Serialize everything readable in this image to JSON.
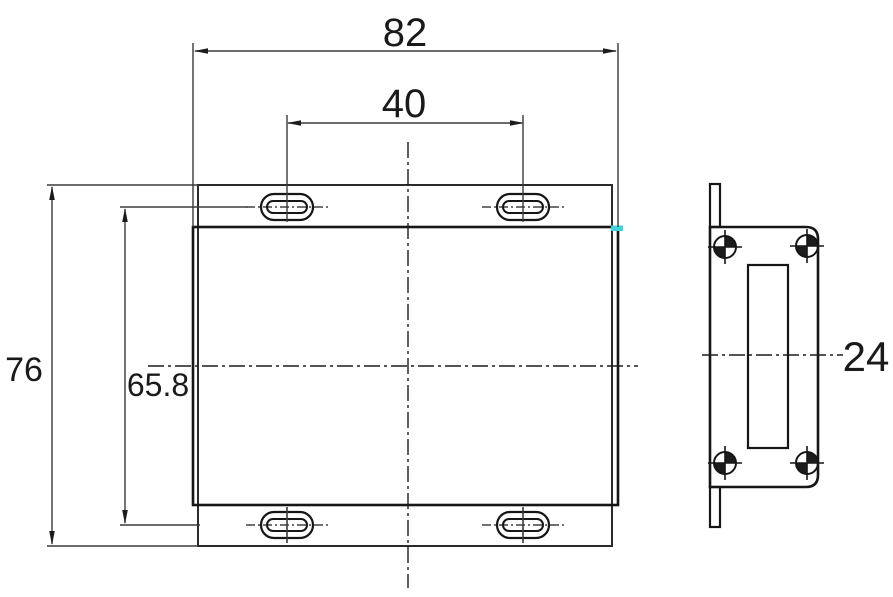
{
  "drawing": {
    "type": "engineering-dimension-drawing",
    "views": {
      "front_view": "enclosure front with mounting flanges and four slotted holes",
      "side_view": "enclosure side profile with four target marks and vertical slot"
    },
    "dimensions": {
      "overall_width": "82",
      "slot_spacing": "40",
      "overall_height": "76",
      "slot_row_spacing": "65.8",
      "side_depth": "24"
    },
    "colors": {
      "line": "#1c1c1c",
      "dimension_line": "#3a3a3a",
      "background": "#ffffff",
      "highlight_marker": "#3fd4d8"
    }
  }
}
